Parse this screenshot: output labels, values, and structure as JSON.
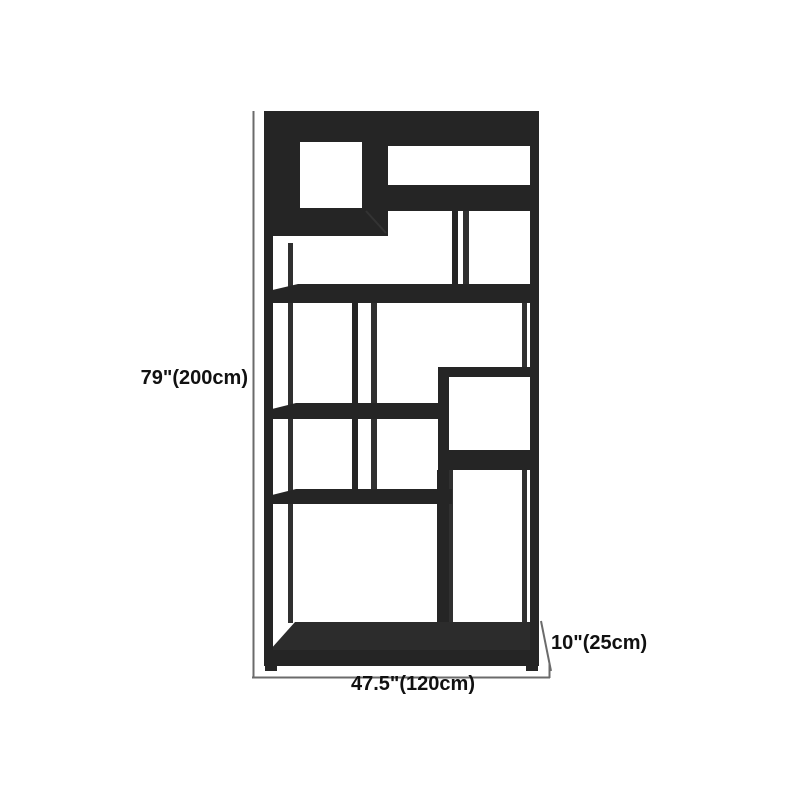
{
  "diagram": {
    "subject": "tall-geometric-etagere-bookshelf",
    "labels": {
      "height": "79\"(200cm)",
      "width": "47.5\"(120cm)",
      "depth": "10\"(25cm)"
    },
    "colors": {
      "background": "#ffffff",
      "shelf_front": "#252525",
      "shelf_top_face": "#2c2c2c",
      "shelf_back_member": "#303030",
      "dimension_line": "#6b6b6b",
      "label_text": "#111111"
    }
  }
}
